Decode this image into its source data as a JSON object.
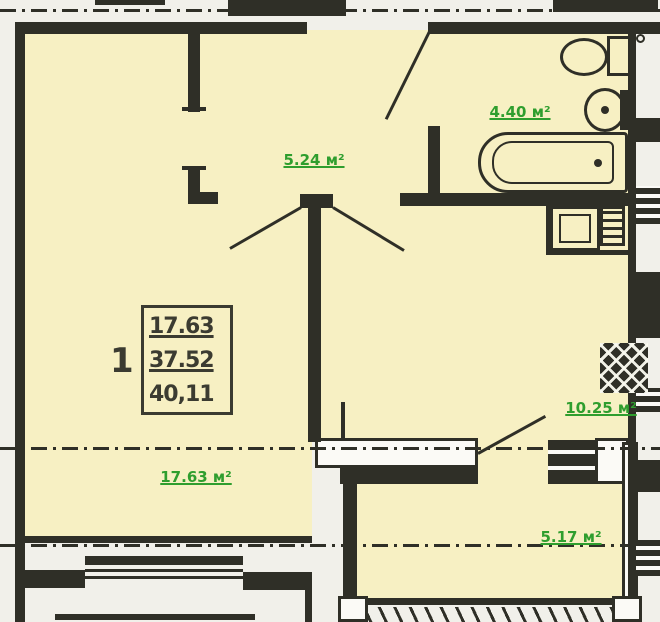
{
  "plan": {
    "unit_label": "1",
    "info_box": {
      "line1": "17.63",
      "line2": "37.52",
      "line3": "40,11"
    },
    "rooms": {
      "hallway": {
        "label": "5.24 м²"
      },
      "bathroom": {
        "label": "4.40 м²"
      },
      "living": {
        "label": "17.63 м²"
      },
      "kitchen": {
        "label": "10.25 м²"
      },
      "balcony": {
        "label": "5.17 м²"
      }
    },
    "colors": {
      "floor": "#f7f0c3",
      "wall": "#2f2f27",
      "label_green": "#2f9e2e",
      "box_text": "#3b3b31",
      "background": "#f1f0ea",
      "white": "#fbfaf6"
    }
  }
}
